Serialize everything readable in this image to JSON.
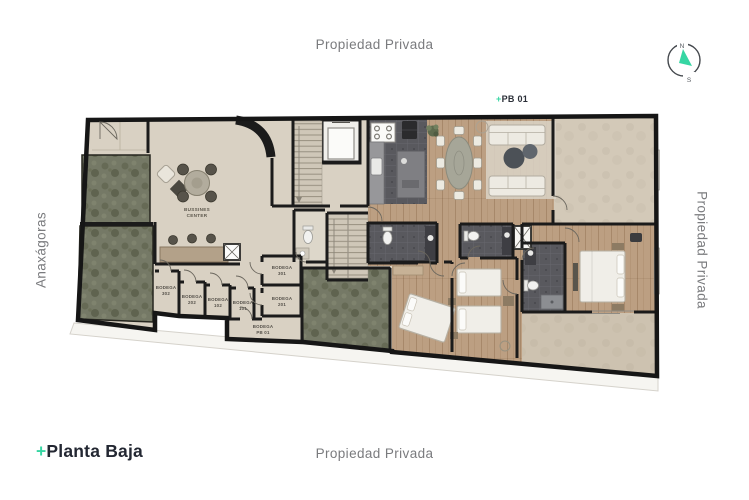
{
  "page": {
    "labels": {
      "top": "Propiedad Privada",
      "bottom": "Propiedad Privada",
      "right": "Propiedad Privada",
      "left": "Anaxágoras"
    },
    "title": {
      "plus": "+",
      "text": "Planta Baja"
    },
    "unit_tag": {
      "plus": "+",
      "text": "PB 01"
    },
    "compass": {
      "north": "N",
      "south": "S"
    }
  },
  "plan": {
    "business_center": {
      "line1": "BUSSINES",
      "line2": "CENTER"
    },
    "bodegas": [
      {
        "line1": "BODEGA",
        "line2": "302"
      },
      {
        "line1": "BODEGA",
        "line2": "202"
      },
      {
        "line1": "BODEGA",
        "line2": "102"
      },
      {
        "line1": "BODEGA",
        "line2": "101"
      },
      {
        "line1": "BODEGA",
        "line2": "301"
      },
      {
        "line1": "BODEGA",
        "line2": "201"
      },
      {
        "line1": "BODEGA",
        "line2": "PB 01"
      }
    ]
  },
  "colors": {
    "accent_teal": "#36d6a3",
    "title_navy": "#232732",
    "label_gray": "#7a7b7e",
    "wall": "#1b1b1b",
    "floor_beige": "#d9d1c3",
    "wood": "#bc9f82",
    "tile_dark": "#59595e",
    "garden_green": "#757966",
    "terrace_beige": "#d3c9b8"
  }
}
